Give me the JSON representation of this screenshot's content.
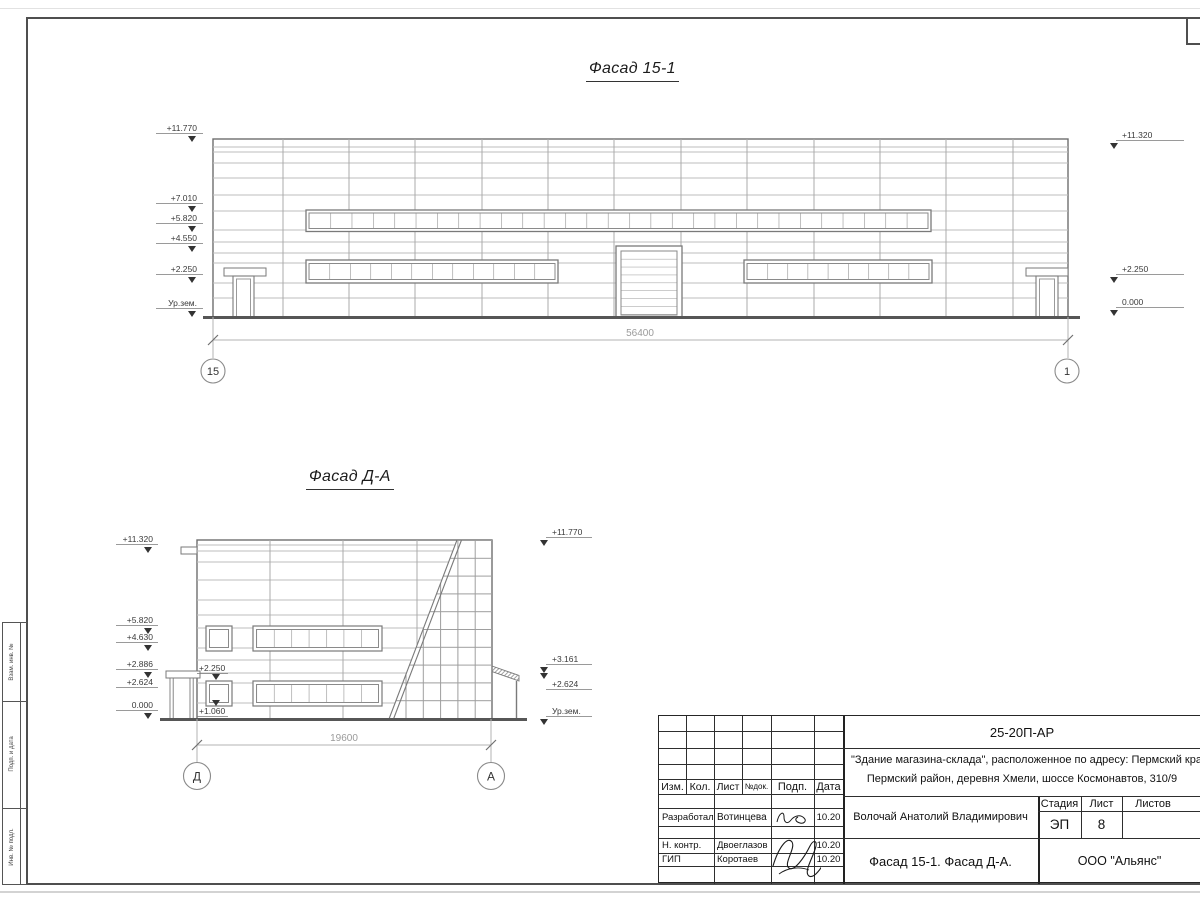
{
  "f1": {
    "title": "Фасад 15-1",
    "left": [
      "+11.770",
      "+7.010",
      "+5.820",
      "+4.550",
      "+2.250",
      "Ур.зем."
    ],
    "right": [
      "+11.320",
      "+2.250",
      "0.000"
    ],
    "dim": "56400",
    "axisL": "15",
    "axisR": "1"
  },
  "f2": {
    "title": "Фасад Д-А",
    "left": [
      "+11.320",
      "+5.820",
      "+4.630",
      "+2.886",
      "+2.624",
      "0.000"
    ],
    "right": [
      "+11.770",
      "+3.161",
      "+2.624",
      "Ур.зем."
    ],
    "inner": [
      "+2.250",
      "+1.060"
    ],
    "dim": "19600",
    "axisL": "Д",
    "axisR": "А"
  },
  "tb": {
    "code": "25-20П-АР",
    "project1": "\"Здание магазина-склада\", расположенное по адресу: Пермский край,",
    "project2": "Пермский район, деревня Хмели, шоссе Космонавтов, 310/9",
    "cols": {
      "izm": "Изм.",
      "kol": "Кол.",
      "list": "Лист",
      "ndok": "№док.",
      "podp": "Подп.",
      "data": "Дата"
    },
    "rows": [
      {
        "role": "Разработал",
        "name": "Вотинцева",
        "date": "10.20"
      },
      {
        "role": "Н. контр.",
        "name": "Двоеглазов",
        "date": "10.20"
      },
      {
        "role": "ГИП",
        "name": "Коротаев",
        "date": "10.20"
      }
    ],
    "customer": "Волочай Анатолий Владимирович",
    "stage_label": "Стадия",
    "list_label": "Лист",
    "listov_label": "Листов",
    "stage": "ЭП",
    "sheet": "8",
    "name": "Фасад 15-1. Фасад Д-А.",
    "org": "ООО \"Альянс\""
  },
  "strip": {
    "labels": [
      "Взам. инв. №",
      "Подп. и дата",
      "Инв. № подл."
    ]
  }
}
